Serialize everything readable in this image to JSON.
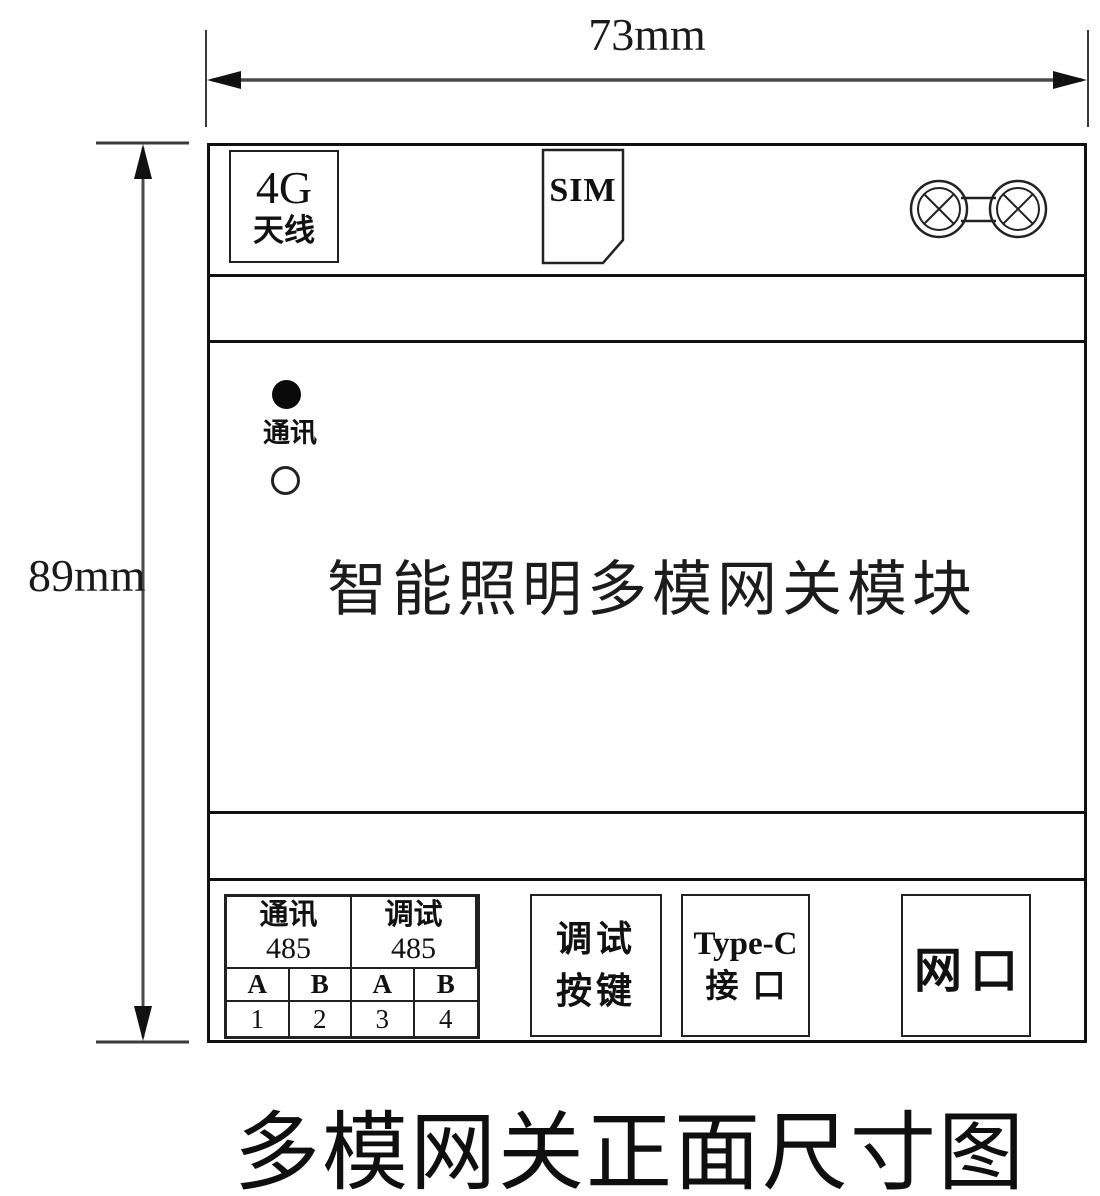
{
  "colors": {
    "ink": "#111111",
    "paper": "#ffffff",
    "dim_line": "#4a4a4a"
  },
  "dimensions": {
    "width_label": "73mm",
    "height_label": "89mm"
  },
  "device": {
    "top_panel": {
      "antenna_box": {
        "line1": "4G",
        "line2": "天线"
      },
      "sim_label": "SIM",
      "icons": {
        "sim": "sim-card-outline-icon",
        "rf_connectors": "dual-coax-antenna-connector-icon"
      }
    },
    "indicators": {
      "comm_led_label": "通讯"
    },
    "title": "智能照明多模网关模块",
    "bottom_panel": {
      "terminal_table": {
        "groups": [
          {
            "line1": "通讯",
            "line2": "485"
          },
          {
            "line1": "调试",
            "line2": "485"
          }
        ],
        "pins": [
          "A",
          "B",
          "A",
          "B"
        ],
        "numbers": [
          "1",
          "2",
          "3",
          "4"
        ]
      },
      "debug_button": {
        "line1": "调试",
        "line2": "按键"
      },
      "typec_port": {
        "line1": "Type-C",
        "line2": "接口"
      },
      "ethernet_port": {
        "label": "网口"
      }
    }
  },
  "caption": "多模网关正面尺寸图"
}
